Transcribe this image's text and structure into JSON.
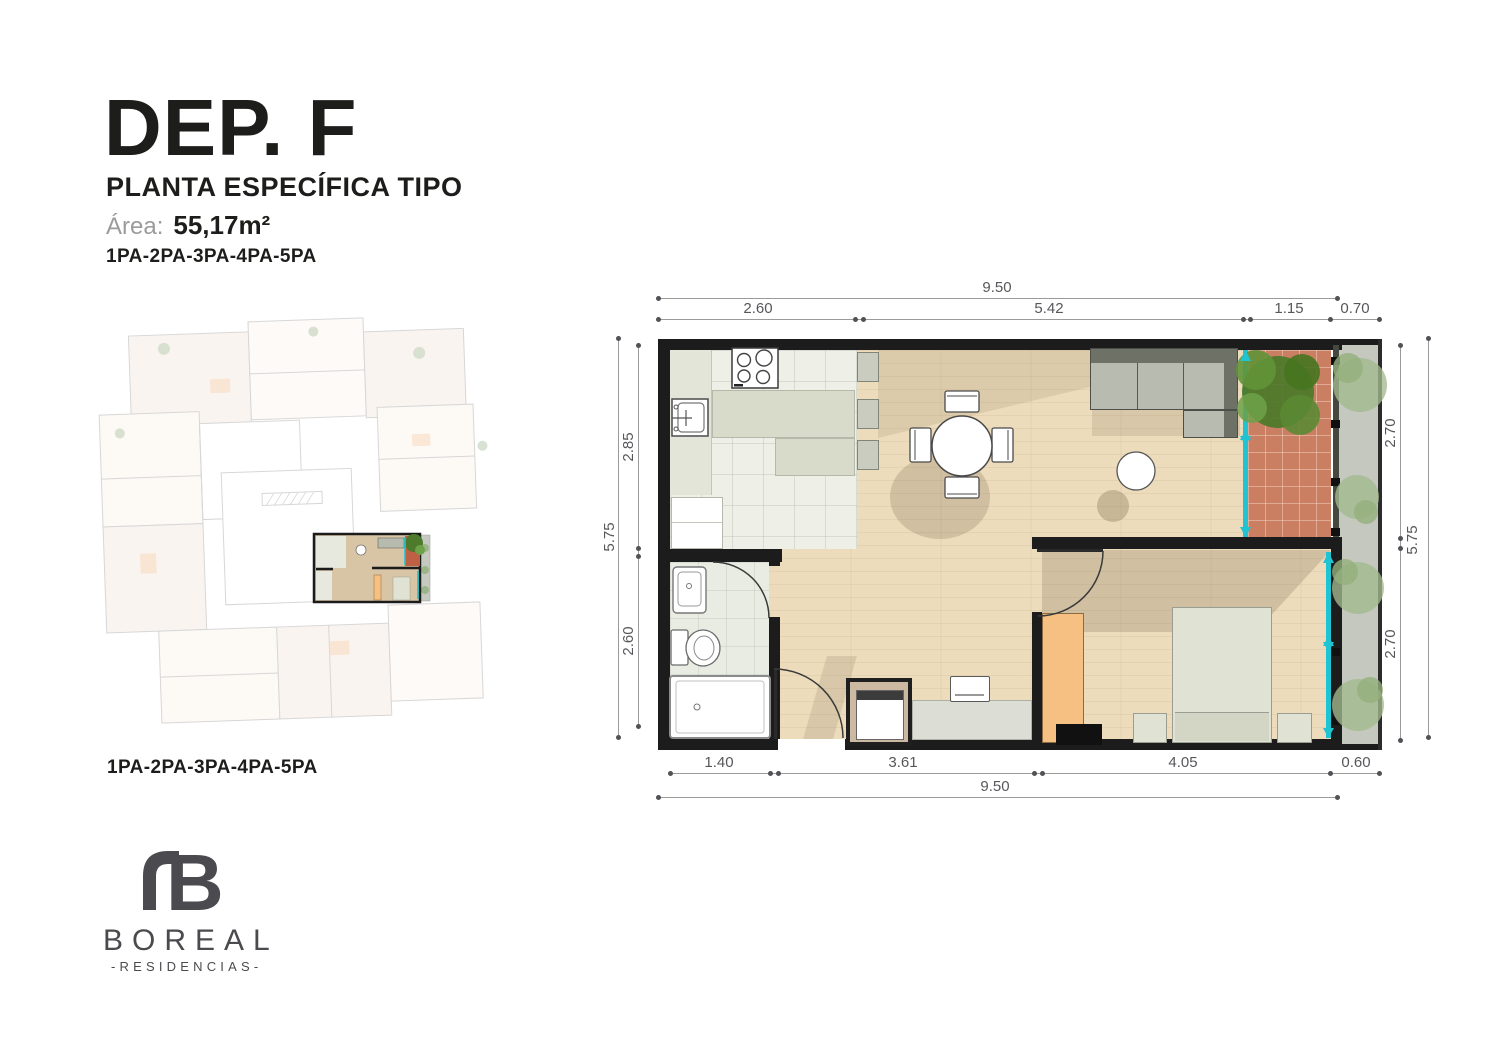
{
  "header": {
    "title": "DEP. F",
    "subtitle": "PLANTA ESPECÍFICA TIPO",
    "area_label": "Área:",
    "area_value": "55,17m²",
    "levels": "1PA-2PA-3PA-4PA-5PA"
  },
  "overview": {
    "caption": "1PA-2PA-3PA-4PA-5PA"
  },
  "brand": {
    "mark": "B",
    "name": "BOREAL",
    "tagline": "-RESIDENCIAS-"
  },
  "plan": {
    "dimensions": {
      "top_total": "9.50",
      "top_segments": [
        "2.60",
        "5.42",
        "1.15",
        "0.70"
      ],
      "bottom_segments": [
        "1.40",
        "3.61",
        "4.05",
        "0.60"
      ],
      "bottom_total": "9.50",
      "left_total": "5.75",
      "left_segments": [
        "2.85",
        "2.60"
      ],
      "right_segments": [
        "2.70",
        "2.70"
      ],
      "right_total": "5.75"
    }
  },
  "theme": {
    "ink": "#1d1d1b",
    "wall": "#1c1c1c",
    "wood_floor": "#ecdcbc",
    "kitchen_floor": "#eef0e7",
    "counter": "#d8dbc9",
    "balcony_tile": "#ca7f63",
    "window_accent": "#1fc3d2",
    "wardrobe": "#f6c083",
    "furniture_sage": "#e0e3d4",
    "sofa_back": "#6e7266",
    "sofa_seat": "#b8bcb0",
    "garden_path": "#c5c8bf",
    "bush_green": "#a3ba8e",
    "tree_green": "#4e7a2b",
    "dim_line": "#9a9a9a",
    "dim_text": "#56575a",
    "logo_gray": "#4b4b4f"
  }
}
